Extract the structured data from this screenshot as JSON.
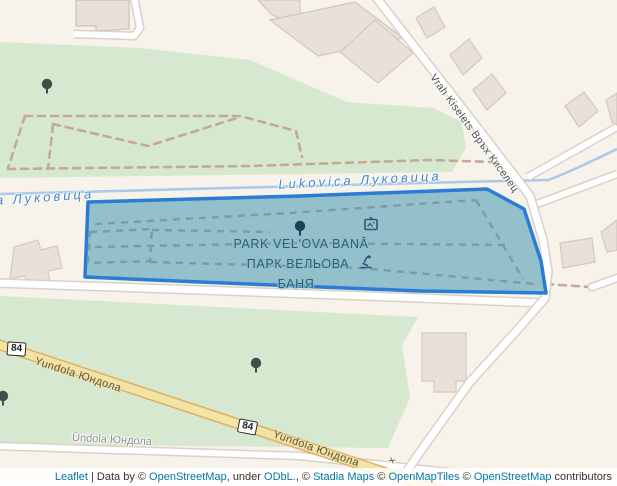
{
  "map": {
    "labels": {
      "park_line1": "PARK VELʹOVA BANÂ",
      "park_line2": "ПАРК ВЕЛЬОВА",
      "park_line3": "БАНЯ",
      "river_left": "а Луковица",
      "river_right": "Lukovica Луковица",
      "road_diagonal": "Vrah Kiselets Връх Киселец",
      "road_yellow_1": "Yundola Юндола",
      "road_yellow_2": "Yundola Юндола",
      "road_white_bottom": "Ûndola Юндола",
      "road_label_fragment": "х",
      "shield_84": "84"
    },
    "icons": [
      "tree-icon",
      "artwork-icon",
      "fountain-icon"
    ],
    "colors": {
      "land": "#f7f2ea",
      "green": "#d7e8d0",
      "park_fill": "#8fbdc9",
      "park_border": "#2a7cd4",
      "river": "#a9cbe9",
      "road_yellow_fill": "#f3e3a4",
      "road_yellow_casing": "#ddb066",
      "road_white": "#ffffff",
      "road_casing": "#d8d2c8",
      "building": "#e9e1d8",
      "building_line": "#d2c9c0",
      "path_brown_dashed": "#c5a898",
      "path_gray_dashed": "#7f99a8",
      "label_park": "#2d6076",
      "label_river": "#3e86c8",
      "label_road": "#4c4c4c",
      "tree": "#3f4e46",
      "tree_park": "#16435a",
      "attribution_link": "#0078a8"
    }
  },
  "attribution": {
    "segments": [
      {
        "text": "Leaflet",
        "link": true
      },
      {
        "text": " | Data by © ",
        "link": false
      },
      {
        "text": "OpenStreetMap",
        "link": true
      },
      {
        "text": ", under ",
        "link": false
      },
      {
        "text": "ODbL.",
        "link": true
      },
      {
        "text": ", © ",
        "link": false
      },
      {
        "text": "Stadia Maps",
        "link": true
      },
      {
        "text": " © ",
        "link": false
      },
      {
        "text": "OpenMapTiles",
        "link": true
      },
      {
        "text": " © ",
        "link": false
      },
      {
        "text": "OpenStreetMap",
        "link": true
      },
      {
        "text": " contributors",
        "link": false
      }
    ]
  }
}
